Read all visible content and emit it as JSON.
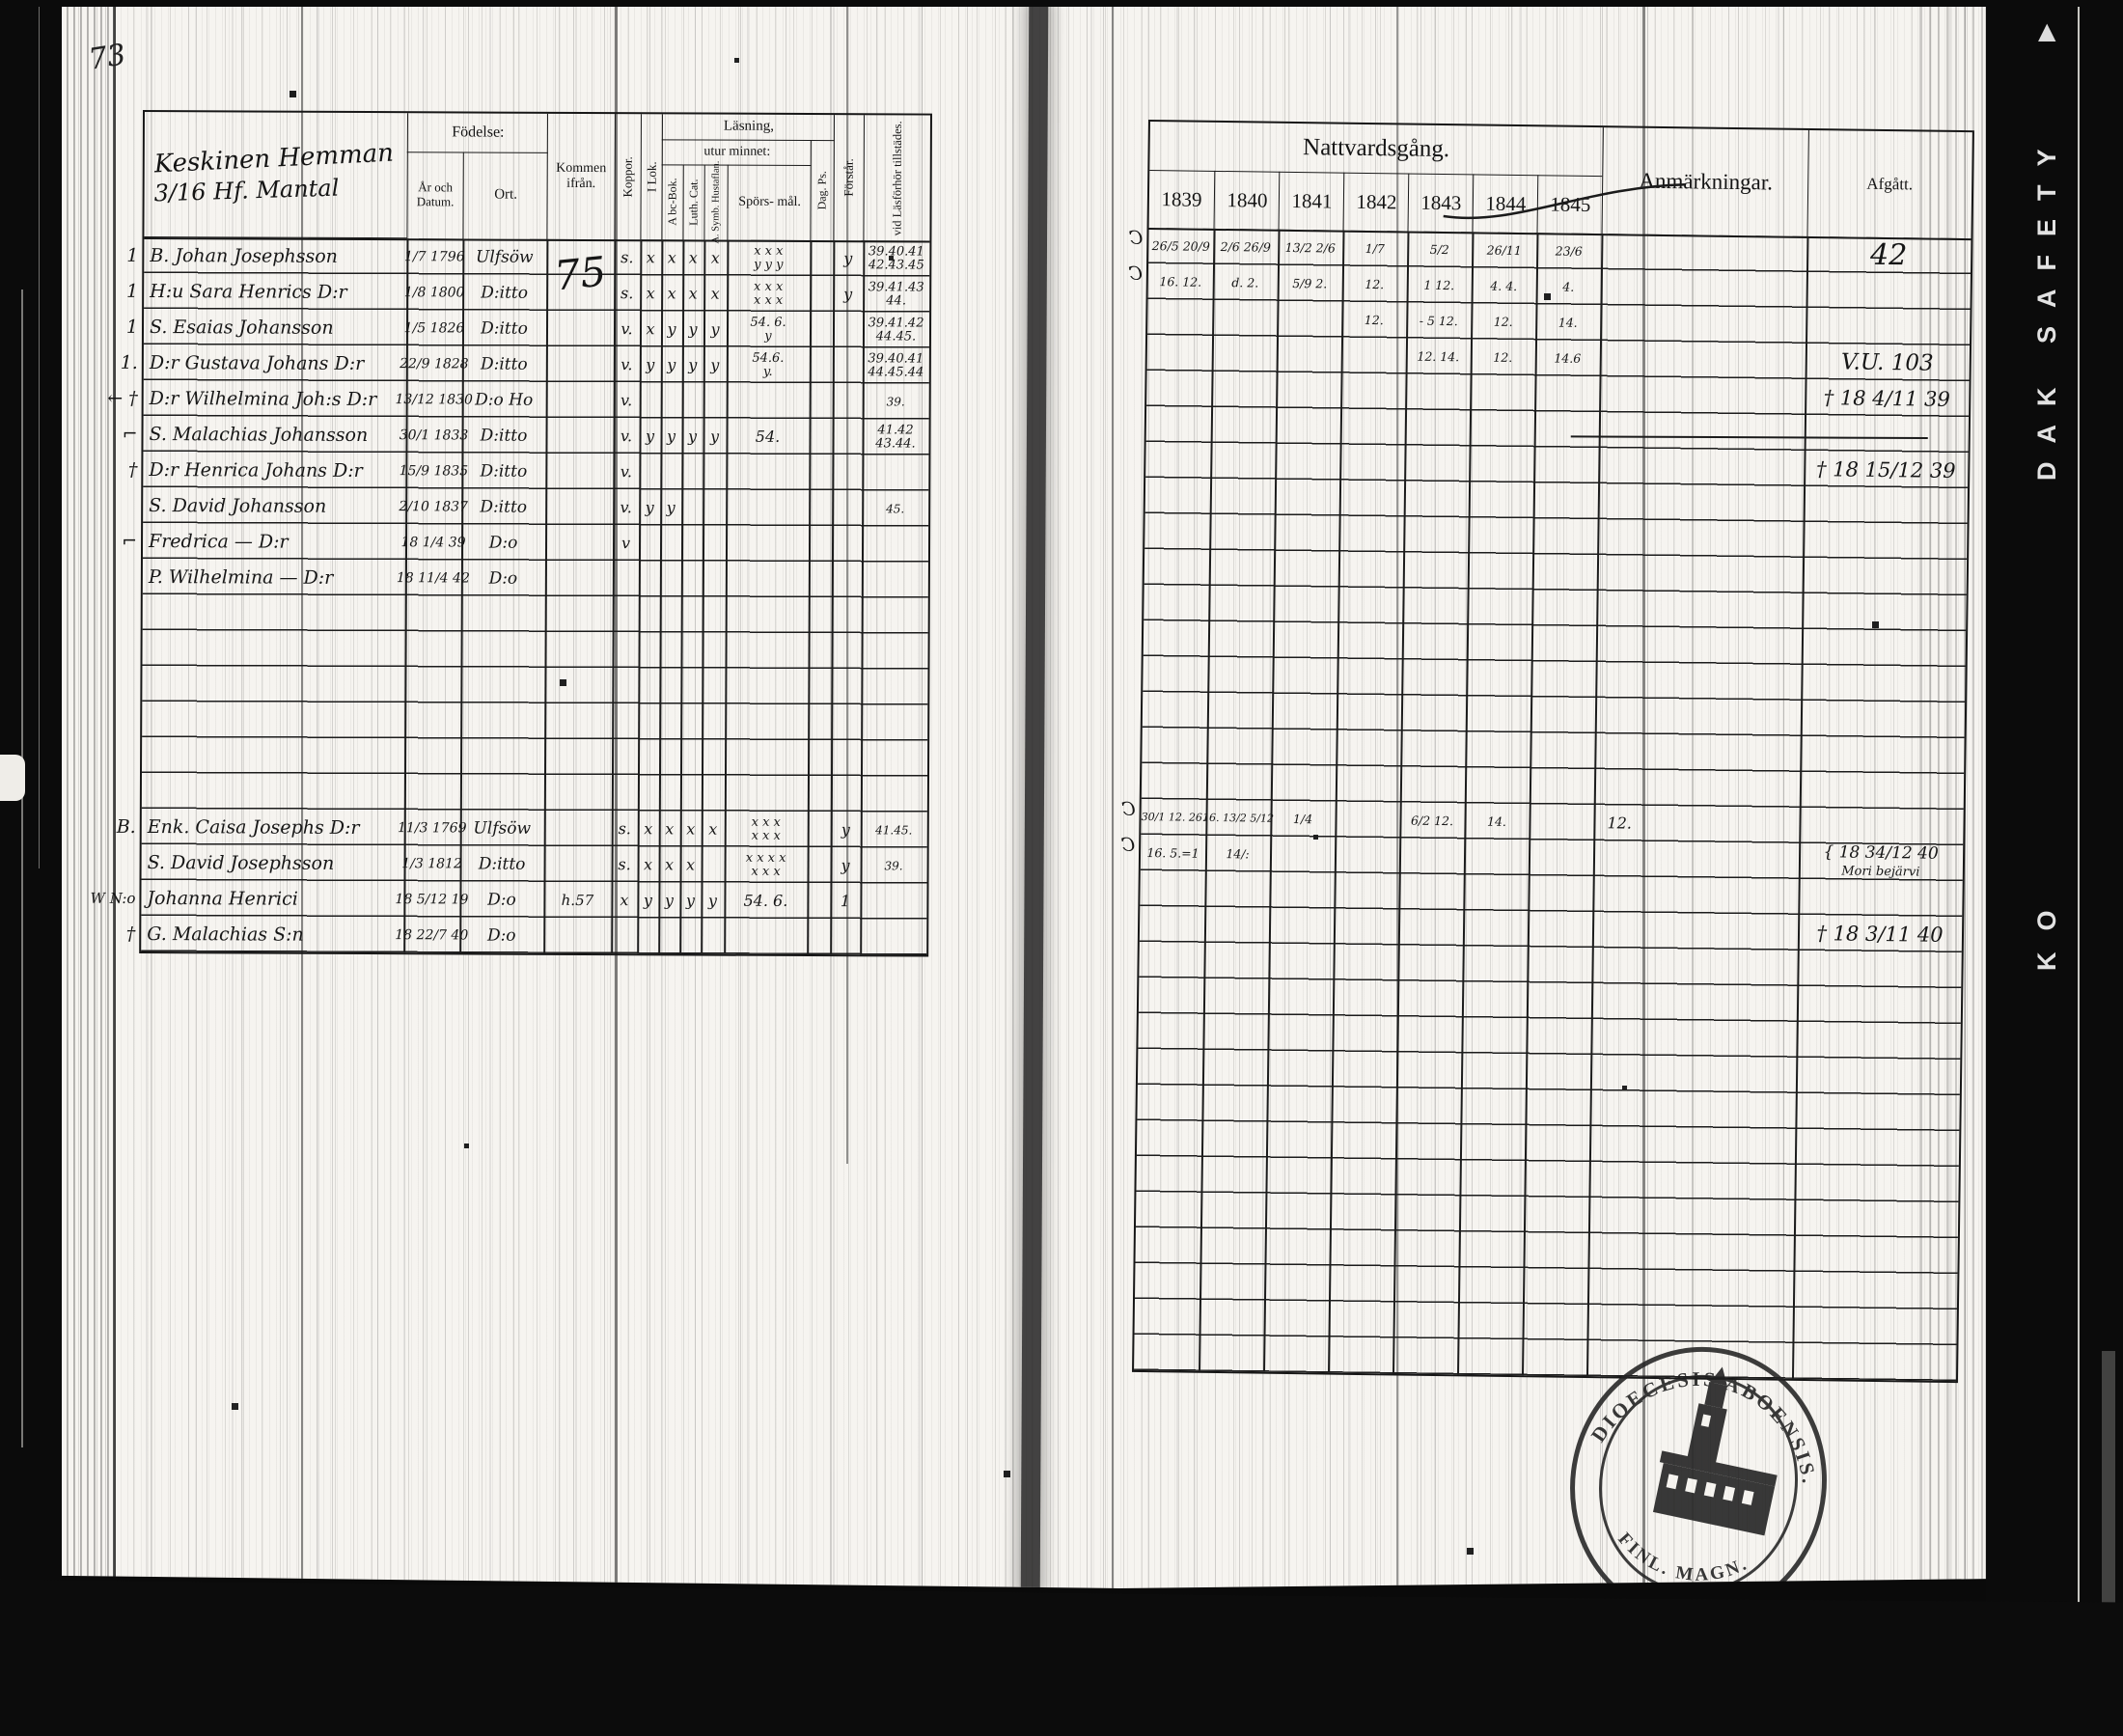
{
  "film": {
    "brand_upper": "DAK SAFETY",
    "brand_lower": "KO",
    "triangle": "▲",
    "film_black": "#0b0b0b",
    "paper_white": "#f6f4f0",
    "ink": "#1b1b1b"
  },
  "page": {
    "number": "73"
  },
  "left_page": {
    "title": {
      "line1": "Keskinen Hemman",
      "line2": "3/16 Hf. Mantal"
    },
    "headers": {
      "fodelse": "Födelse:",
      "ar_och_datum": "År och Datum.",
      "ort": "Ort.",
      "kommen_ifran": "Kommen ifrån.",
      "koppor": "Koppor.",
      "i_lok": "I Lok.",
      "lasning": "Läsning,",
      "utur_minnet": "utur minnet:",
      "abc_bok": "A bc-Bok.",
      "luth_cat": "Luth. Cat.",
      "symb_hustaflan": "A. Symb. Hustaflan.",
      "sporsmal": "Spörs- mål.",
      "dag_ps": "Dag. Ps.",
      "forstar": "Förstår.",
      "vid_lasforhor": "vid Läsförhör tillstädes."
    },
    "block1": [
      {
        "m": "1",
        "name": "B. Johan Josephsson",
        "d": "1/7 1796",
        "ort": "Ulfsöw",
        "kom": "75",
        "ko": "s.",
        "il": "x",
        "ab": "x",
        "lu": "x",
        "hu": "x",
        "sp": "x x x",
        "sp2": "y y y",
        "fo": "y",
        "na": "39.40.41",
        "na2": "42.43.45"
      },
      {
        "m": "1",
        "name": "H:u Sara Henrics D:r",
        "d": "1/8 1800",
        "ort": "D:itto",
        "ko": "s.",
        "il": "x",
        "ab": "x",
        "lu": "x",
        "hu": "x",
        "sp": "x x x",
        "sp2": "x x x",
        "fo": "y",
        "na": "39.41.43",
        "na2": "44."
      },
      {
        "m": "1",
        "name": "S. Esaias Johansson",
        "d": "1/5 1826",
        "ort": "D:itto",
        "ko": "v.",
        "il": "x",
        "ab": "y",
        "lu": "y",
        "hu": "y",
        "sp": "54. 6.",
        "sp2": "y",
        "na": "39.41.42",
        "na2": "44.45."
      },
      {
        "m": "1.",
        "name": "D:r Gustava Johans D:r",
        "d": "22/9 1828",
        "ort": "D:itto",
        "ko": "v.",
        "il": "y",
        "ab": "y",
        "lu": "y",
        "hu": "y",
        "sp": "54.6.",
        "sp2": "y.",
        "na": "39.40.41",
        "na2": "44.45.44"
      },
      {
        "m": "← †",
        "name": "D:r Wilhelmina Joh:s D:r",
        "d": "13/12 1830",
        "ort": "D:o Ho",
        "ko": "v.",
        "na": "39."
      },
      {
        "m": "⌐",
        "name": "S. Malachias Johansson",
        "d": "30/1 1833",
        "ort": "D:itto",
        "ko": "v.",
        "il": "y",
        "ab": "y",
        "lu": "y",
        "hu": "y",
        "sp": "54.",
        "na": "41.42",
        "na2": "43.44."
      },
      {
        "m": "†",
        "name": "D:r Henrica Johans D:r",
        "d": "15/9 1835",
        "ort": "D:itto",
        "ko": "v."
      },
      {
        "name": "S. David Johansson",
        "d": "2/10 1837",
        "ort": "D:itto",
        "ko": "v.",
        "il": "y",
        "ab": "y",
        "na": "45."
      },
      {
        "m": "⌐",
        "name": "Fredrica  —  D:r",
        "d": "18 1/4 39",
        "ort": "D:o",
        "ko": "v"
      },
      {
        "name": "P. Wilhelmina  —  D:r",
        "d": "18 11/4 42",
        "ort": "D:o"
      }
    ],
    "block2": [
      {
        "m": "B.",
        "name": "Enk. Caisa Josephs D:r",
        "d": "11/3 1769",
        "ort": "Ulfsöw",
        "ko": "s.",
        "il": "x",
        "ab": "x",
        "lu": "x",
        "hu": "x",
        "sp": "x x x",
        "sp2": "x x x",
        "fo": "y",
        "na": "41.45."
      },
      {
        "name": "S. David Josephsson",
        "d": "1/3 1812",
        "ort": "D:itto",
        "ko": "s.",
        "il": "x",
        "ab": "x",
        "lu": "x",
        "sp": "x x x x",
        "sp2": "x x x",
        "fo": "y",
        "na": "39."
      },
      {
        "m": "W N:o",
        "name": "Johanna Henrici",
        "d": "18 5/12 19",
        "ort": "D:o",
        "kom": "h.57",
        "ko": "x",
        "il": "y",
        "ab": "y",
        "lu": "y",
        "hu": "y",
        "sp": "54. 6.",
        "fo": "1"
      },
      {
        "m": "†",
        "name": "G. Malachias S:n",
        "d": "18 22/7 40",
        "ort": "D:o"
      }
    ]
  },
  "right_page": {
    "headers": {
      "nattvardsgang": "Nattvardsgång.",
      "anmarkningar": "Anmärkningar.",
      "afgatt": "Afgått.",
      "years": [
        "1839",
        "1840",
        "1841",
        "1842",
        "1843",
        "1844",
        "1845"
      ]
    },
    "block1": [
      {
        "m": "C",
        "y": [
          "26/5 20/9",
          "2/6 26/9",
          "13/2 2/6",
          "1/7",
          "5/2",
          "26/11",
          "23/6"
        ],
        "af": "42"
      },
      {
        "m": "C",
        "y": [
          "16. 12.",
          "d. 2.",
          "5/9 2.",
          "12.",
          "1 12.",
          "4. 4.",
          "4."
        ]
      },
      {
        "y": [
          "",
          "",
          "",
          "12.",
          "- 5 12.",
          "12.",
          "14."
        ]
      },
      {
        "y": [
          "",
          "",
          "",
          "",
          "12. 14.",
          "12.",
          "14.6"
        ],
        "af": "V.U. 103"
      },
      {
        "af": "† 18 4/11 39"
      },
      {},
      {
        "af": "† 18 15/12 39"
      }
    ],
    "block2": [
      {
        "m": "C",
        "y": [
          "30/1 12. 26.",
          "16. 13/2 5/12",
          "1/4",
          "",
          "6/2 12.",
          "14.",
          ""
        ],
        "anm": "12."
      },
      {
        "m": "C",
        "y": [
          "16. 5.=1",
          "14/:",
          "",
          "",
          "",
          "",
          ""
        ],
        "af": "{ 18 34/12 40",
        "af2": "Mori bejärvi"
      },
      {},
      {
        "af": "† 18 3/11 40"
      }
    ]
  },
  "stamp": {
    "arc_top": "DIOECESIS ABOENSIS.",
    "arc_bottom": "FINL. MAGN."
  }
}
